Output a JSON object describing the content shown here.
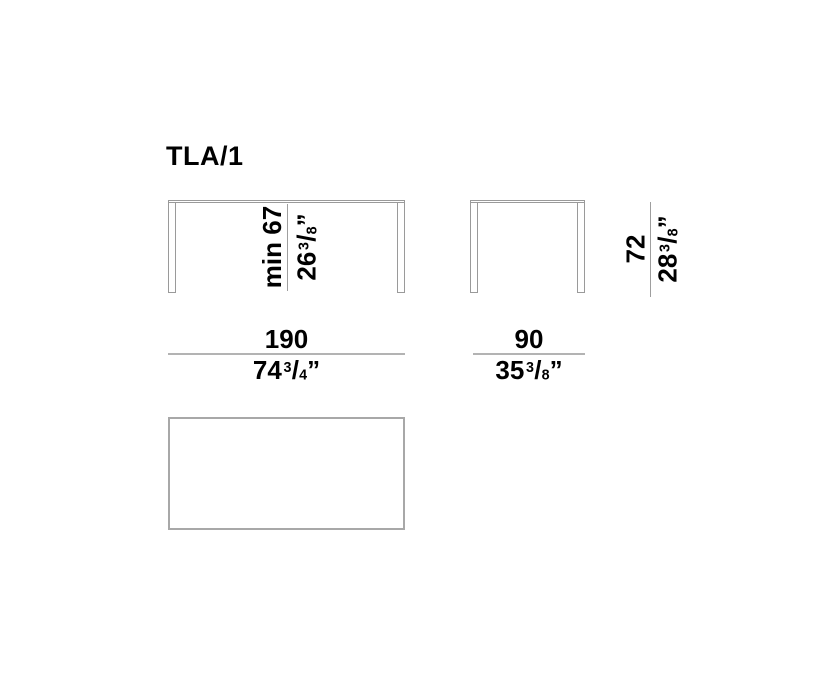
{
  "title": "TLA/1",
  "colors": {
    "outline_gray": "#9a9a9a",
    "dimension_rule_gray": "#b3b3b3",
    "height_dim_line_gray": "#9e9e9e",
    "text": "#000000",
    "background": "#ffffff"
  },
  "dimensions": {
    "front_height": {
      "metric": "min 67",
      "imperial_whole": "26",
      "imperial_numerator": "3",
      "imperial_denominator": "8",
      "inch_mark": "”"
    },
    "front_width": {
      "metric": "190",
      "imperial_whole": "74",
      "imperial_numerator": "3",
      "imperial_denominator": "4",
      "inch_mark": "”"
    },
    "side_height": {
      "metric": "72",
      "imperial_whole": "28",
      "imperial_numerator": "3",
      "imperial_denominator": "8",
      "inch_mark": "”"
    },
    "side_width": {
      "metric": "90",
      "imperial_whole": "35",
      "imperial_numerator": "3",
      "imperial_denominator": "8",
      "inch_mark": "”"
    }
  }
}
